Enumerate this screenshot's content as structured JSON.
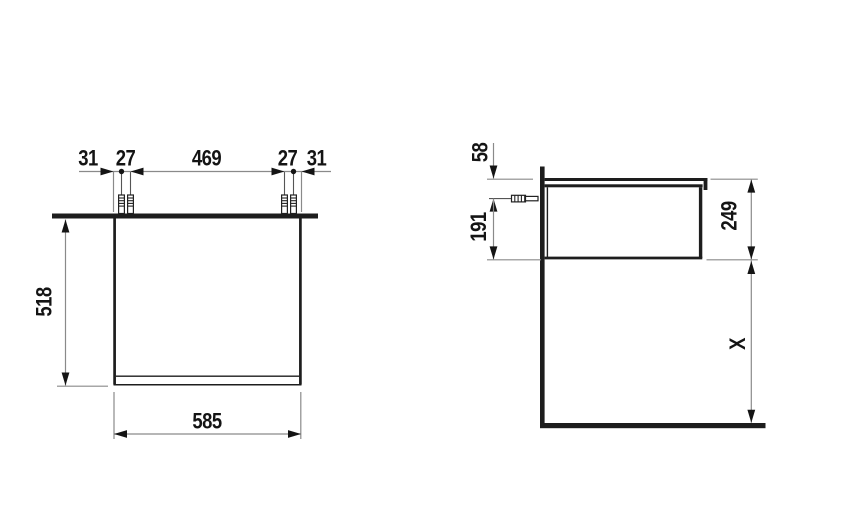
{
  "colors": {
    "background": "#ffffff",
    "outline": "#1d1d1d",
    "dimension_line": "#8a8a8a",
    "text": "#141414"
  },
  "front_view": {
    "label_left_offset": "31",
    "label_left_screw_spacing": "27",
    "label_screw_span": "469",
    "label_right_screw_spacing": "27",
    "label_right_offset": "31",
    "label_height": "518",
    "label_width": "585"
  },
  "side_view": {
    "label_top_to_mount": "58",
    "label_mount_to_bottom": "191",
    "label_body_height": "249",
    "label_floor_clearance": "X"
  }
}
